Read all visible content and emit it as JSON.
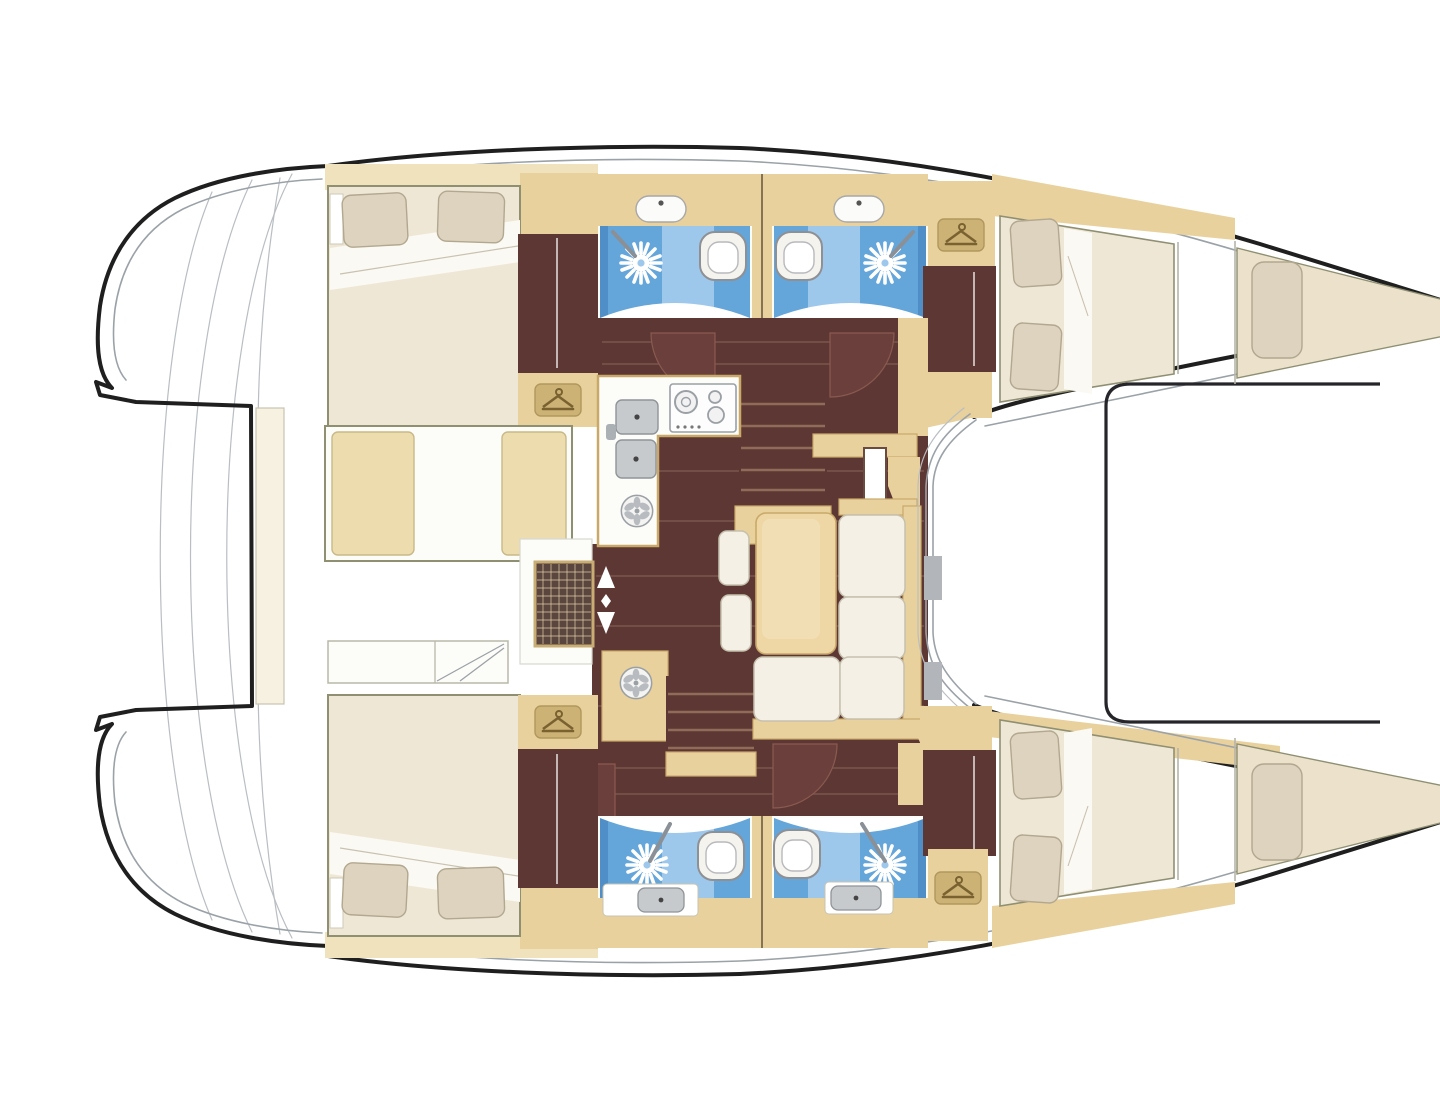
{
  "document": {
    "title": "Catamaran interior layout floor plan, top view, bows pointing right",
    "type": "boat-floor-plan",
    "visible_text": "none"
  },
  "colors": {
    "page_bg": "#ffffff",
    "outline": "#1f1f1f",
    "line_gray": "#9aa2a8",
    "line_light": "#b9bec2",
    "tan": "#e8d19c",
    "tan_light": "#f0e2bd",
    "tan_dark": "#c9a96a",
    "tan_deep": "#cdb276",
    "floor_brown": "#5d3733",
    "brown_light": "#8a5a50",
    "door_brown": "#6b403c",
    "step_line": "#8f6c59",
    "blue": "#64a5da",
    "blue_light": "#9dc8ec",
    "blue_dark": "#4f8ec6",
    "white_soft": "#fcfcf9",
    "mattress": "#efe7d6",
    "pillow": "#ded3bf",
    "pillow_edge": "#b2a78f",
    "cushion_white": "#f4f0e5",
    "cushion_edge": "#c6c0ae",
    "cream": "#f7f1e1",
    "steel": "#c6cacd",
    "steel_dark": "#8f9498",
    "grate": "#5a463e",
    "grate_frame": "#c9ad74",
    "icon_brown": "#7a6230",
    "sheet_white": "#fbf9f3"
  },
  "vessel": {
    "type": "sailing catamaran",
    "view": "top-down interior layout",
    "bow_direction": "right",
    "hulls": [
      {
        "name": "port hull (top)",
        "rooms": [
          {
            "name": "aft double cabin",
            "features": [
              "double berth",
              "2 pillows",
              "wardrobe",
              "hanging locker"
            ]
          },
          {
            "name": "aft bathroom",
            "features": [
              "shower",
              "toilet",
              "washbasin"
            ]
          },
          {
            "name": "forward bathroom",
            "features": [
              "shower",
              "toilet",
              "washbasin"
            ]
          },
          {
            "name": "hanging locker"
          },
          {
            "name": "forward double cabin",
            "features": [
              "double berth",
              "2 pillows"
            ]
          },
          {
            "name": "forepeak berth",
            "features": [
              "single berth",
              "1 pillow"
            ]
          }
        ]
      },
      {
        "name": "starboard hull (bottom)",
        "rooms": [
          {
            "name": "aft double cabin",
            "features": [
              "double berth",
              "2 pillows",
              "wardrobe",
              "hanging locker"
            ]
          },
          {
            "name": "aft bathroom",
            "features": [
              "shower",
              "toilet",
              "washbasin"
            ]
          },
          {
            "name": "forward bathroom",
            "features": [
              "shower",
              "toilet",
              "washbasin"
            ]
          },
          {
            "name": "hanging locker"
          },
          {
            "name": "forward double cabin",
            "features": [
              "double berth",
              "2 pillows"
            ]
          },
          {
            "name": "forepeak berth",
            "features": [
              "single berth",
              "1 pillow"
            ]
          }
        ]
      }
    ],
    "bridgedeck": {
      "rooms": [
        {
          "name": "galley",
          "features": [
            "twin sinks",
            "4-burner gas hob",
            "round hatch",
            "vent grate"
          ]
        },
        {
          "name": "salon",
          "features": [
            "dining table",
            "L-shaped sofa",
            "2 stools",
            "chart seat"
          ]
        },
        {
          "name": "companionway stairs",
          "count": 2
        },
        {
          "name": "cabin swing doors",
          "count": 4
        },
        {
          "name": "up-down access arrows",
          "count": 1
        }
      ]
    },
    "exterior": {
      "features": [
        "aft platform with transom curves",
        "aft crossbeam",
        "forward trampoline frame",
        "twin pointed bows",
        "wrap-around salon windshield"
      ]
    }
  },
  "icons": [
    "hanger-icon",
    "shower-icon",
    "toilet-icon",
    "washbasin-icon",
    "galley-sink-icon",
    "hob-icon",
    "round-hatch-icon",
    "vent-grate-icon",
    "up-down-arrows-icon",
    "door-swing-icon"
  ]
}
